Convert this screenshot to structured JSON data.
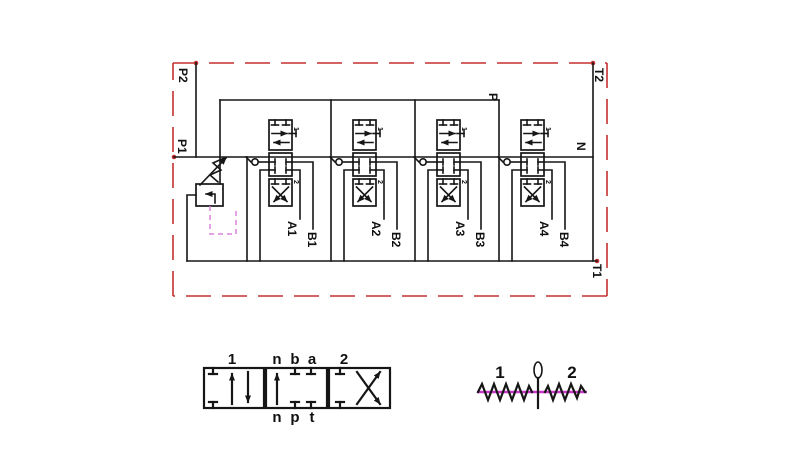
{
  "title": "4-spool hydraulic directional control valve schematic",
  "colors": {
    "line": "#161616",
    "border": "#c53030",
    "pilot": "#da84da",
    "magenta": "#c837c8"
  },
  "schematic": {
    "ports": {
      "p1": "P1",
      "p2": "P2",
      "t1": "T1",
      "t2": "T2",
      "p": "P",
      "n": "N"
    },
    "sections": [
      {
        "a": "A1",
        "b": "B1",
        "pos1": "1",
        "pos2": "2"
      },
      {
        "a": "A2",
        "b": "B2",
        "pos1": "1",
        "pos2": "2"
      },
      {
        "a": "A3",
        "b": "B3",
        "pos1": "1",
        "pos2": "2"
      },
      {
        "a": "A4",
        "b": "B4",
        "pos1": "1",
        "pos2": "2"
      }
    ]
  },
  "legend_valve": {
    "pos_left": "1",
    "pos_right": "2",
    "top_ports": [
      "n",
      "b",
      "a"
    ],
    "bottom_ports": [
      "n",
      "p",
      "t"
    ]
  },
  "legend_lever": {
    "pos_left": "1",
    "pos_right": "2"
  }
}
